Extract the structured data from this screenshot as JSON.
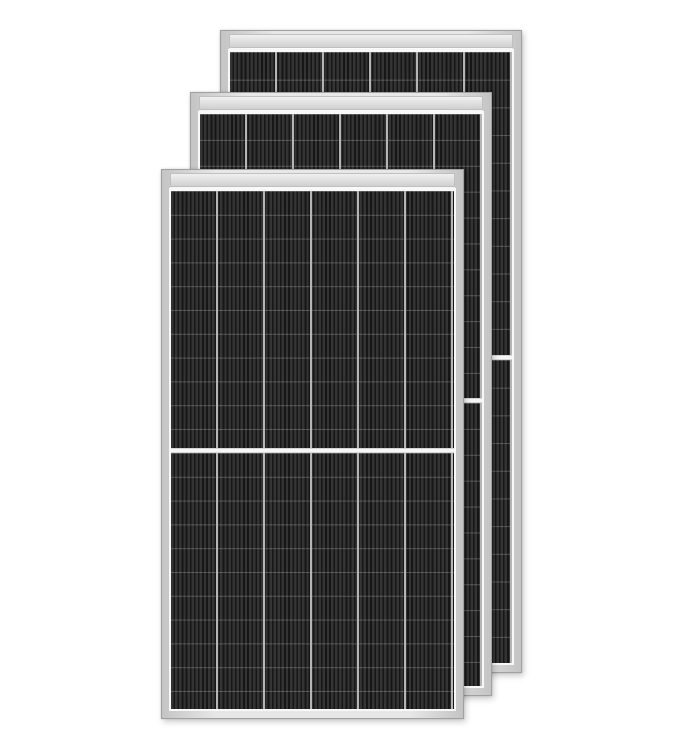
{
  "scene": {
    "description": "Product photo of three framed monocrystalline half-cut solar panels overlapping diagonally, largest in front at lower left, receding to upper right, on a plain white background",
    "panel_count": 3,
    "cells": {
      "columns_per_panel": 6,
      "rows_per_half": 11,
      "halves_per_panel": 2,
      "center_gap": "white horizontal strip across panel middle"
    }
  },
  "colors": {
    "background": "#ffffff",
    "frame_grad_a": "#c4c4c4",
    "frame_grad_b": "#e7e7e7",
    "frame_border": "#a0a0a0",
    "rail_a": "#f0f0f0",
    "rail_b": "#d0d0d0",
    "rail_border": "#bfbfbf",
    "backsheet": "#f8f8f8",
    "cell_base": "#282828",
    "cell_stripe": "#343434",
    "cell_stripe_dark": "#161616",
    "col_divider": "#b5b5b5",
    "row_divider": "rgba(255,255,255,0.22)",
    "center_gap": "#f6f6f6"
  },
  "panels": [
    {
      "id": "back",
      "label": "solar panel, rearmost, offset to upper right"
    },
    {
      "id": "middle",
      "label": "solar panel, middle of stack"
    },
    {
      "id": "front",
      "label": "solar panel, frontmost, lower left"
    }
  ]
}
